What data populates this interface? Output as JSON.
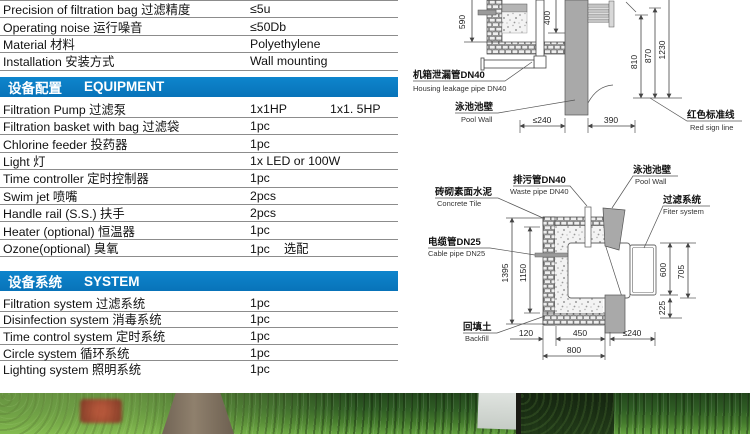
{
  "specs": {
    "rows": [
      {
        "label": "Precision of filtration bag 过滤精度",
        "value": "≤5u"
      },
      {
        "label": "Operating noise 运行噪音",
        "value": "≤50Db"
      },
      {
        "label": "Material 材料",
        "value": "Polyethylene"
      },
      {
        "label": "Installation 安装方式",
        "value": "Wall mounting"
      }
    ]
  },
  "equipment": {
    "header_zh": "设备配置",
    "header_en": "EQUIPMENT",
    "rows": [
      {
        "label": "Filtration Pump 过滤泵",
        "value": "1x1HP",
        "value2": "1x1. 5HP"
      },
      {
        "label": "Filtration basket with bag 过滤袋",
        "value": "1pc",
        "value2": ""
      },
      {
        "label": "Chlorine feeder  投药器",
        "value": "1pc",
        "value2": ""
      },
      {
        "label": "Light 灯",
        "value": "1x LED or 100W",
        "value2": ""
      },
      {
        "label": "Time controller 定时控制器",
        "value": "1pc",
        "value2": ""
      },
      {
        "label": "Swim jet 喷嘴",
        "value": "2pcs",
        "value2": ""
      },
      {
        "label": "Handle rail (S.S.) 扶手",
        "value": "2pcs",
        "value2": ""
      },
      {
        "label": "Heater (optional) 恒温器",
        "value": "1pc",
        "value2": ""
      },
      {
        "label": "Ozone(optional) 臭氧",
        "value": "1pc",
        "value2": "选配"
      }
    ]
  },
  "system": {
    "header_zh": "设备系统",
    "header_en": "SYSTEM",
    "rows": [
      {
        "label": "Filtration system 过滤系统",
        "value": "1pc"
      },
      {
        "label": "Disinfection system 消毒系统",
        "value": "1pc"
      },
      {
        "label": "Time control system 定时系统",
        "value": "1pc"
      },
      {
        "label": "Circle system 循环系统",
        "value": "1pc"
      },
      {
        "label": "Lighting system 照明系统",
        "value": "1pc"
      }
    ]
  },
  "diagram_top": {
    "dims": {
      "d590": "590",
      "d400": "400",
      "d810": "810",
      "d870": "870",
      "d1230": "1230",
      "w240": "≤240",
      "w390": "390"
    },
    "labels": {
      "leak_zh": "机箱泄漏管DN40",
      "leak_en": "Housing leakage pipe DN40",
      "wall_zh": "泳池池壁",
      "wall_en": "Pool Wall",
      "redline_zh": "红色标准线",
      "redline_en": "Red sign line"
    }
  },
  "diagram_bottom": {
    "dims": {
      "d1395": "1395",
      "d1150": "1150",
      "d600": "600",
      "d705": "705",
      "d225": "225",
      "d120": "120",
      "d450": "450",
      "w240": "≤240",
      "d800": "800"
    },
    "labels": {
      "waste_zh": "排污管DN40",
      "waste_en": "Waste pipe DN40",
      "tile_zh": "砖砌素面水泥",
      "tile_en": "Concrete Tile",
      "cable_zh": "电缆管DN25",
      "cable_en": "Cable pipe DN25",
      "wall_zh": "泳池池壁",
      "wall_en": "Pool Wall",
      "filter_zh": "过滤系统",
      "filter_en": "Fiter system",
      "backfill_zh": "回填土",
      "backfill_en": "Backfill"
    }
  },
  "colors": {
    "accent_blue": "#0878c2",
    "line_gray": "#8c8c8c",
    "wall_gray": "#a9a9a9"
  }
}
